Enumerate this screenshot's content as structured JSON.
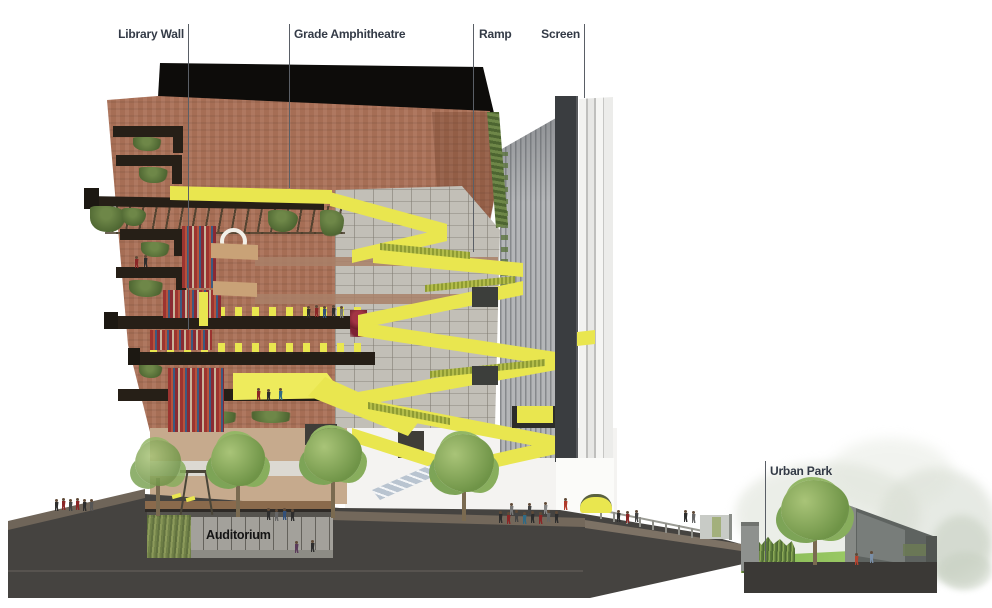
{
  "title": "Building section diagram",
  "labels": {
    "library_wall": "Library Wall",
    "grade_amphitheatre": "Grade Amphitheatre",
    "ramp": "Ramp",
    "screen": "Screen",
    "urban_park": "Urban Park",
    "auditorium": "Auditorium"
  },
  "colors": {
    "label-text": "#333a46",
    "leader": "#5a5f66",
    "roof": "#0d0c0a",
    "brick": "#ab7158",
    "slab": "#261f17",
    "yellow": "#e9e64f",
    "yellow-bright": "#eeeb5c",
    "olive": "#a4ad3c",
    "vine": "#5d7540",
    "glass": "#c2bfb7",
    "louver": "#b4b6b8",
    "screen-dark": "#3a3d40",
    "strip": "#efefed",
    "ground": "#454340",
    "gsurf": "#6f6559",
    "gramp": "#7d7265",
    "deck": "#8a6a4c",
    "tan": "#c6aa8d",
    "tan-band": "#dcd9d2",
    "white-wall": "#f4f3f1",
    "lawn": "#8cc45e",
    "tree": "#7da457",
    "trunk": "#7a6a50",
    "wallgray": "#5e6360",
    "aud-text": "#141414"
  }
}
